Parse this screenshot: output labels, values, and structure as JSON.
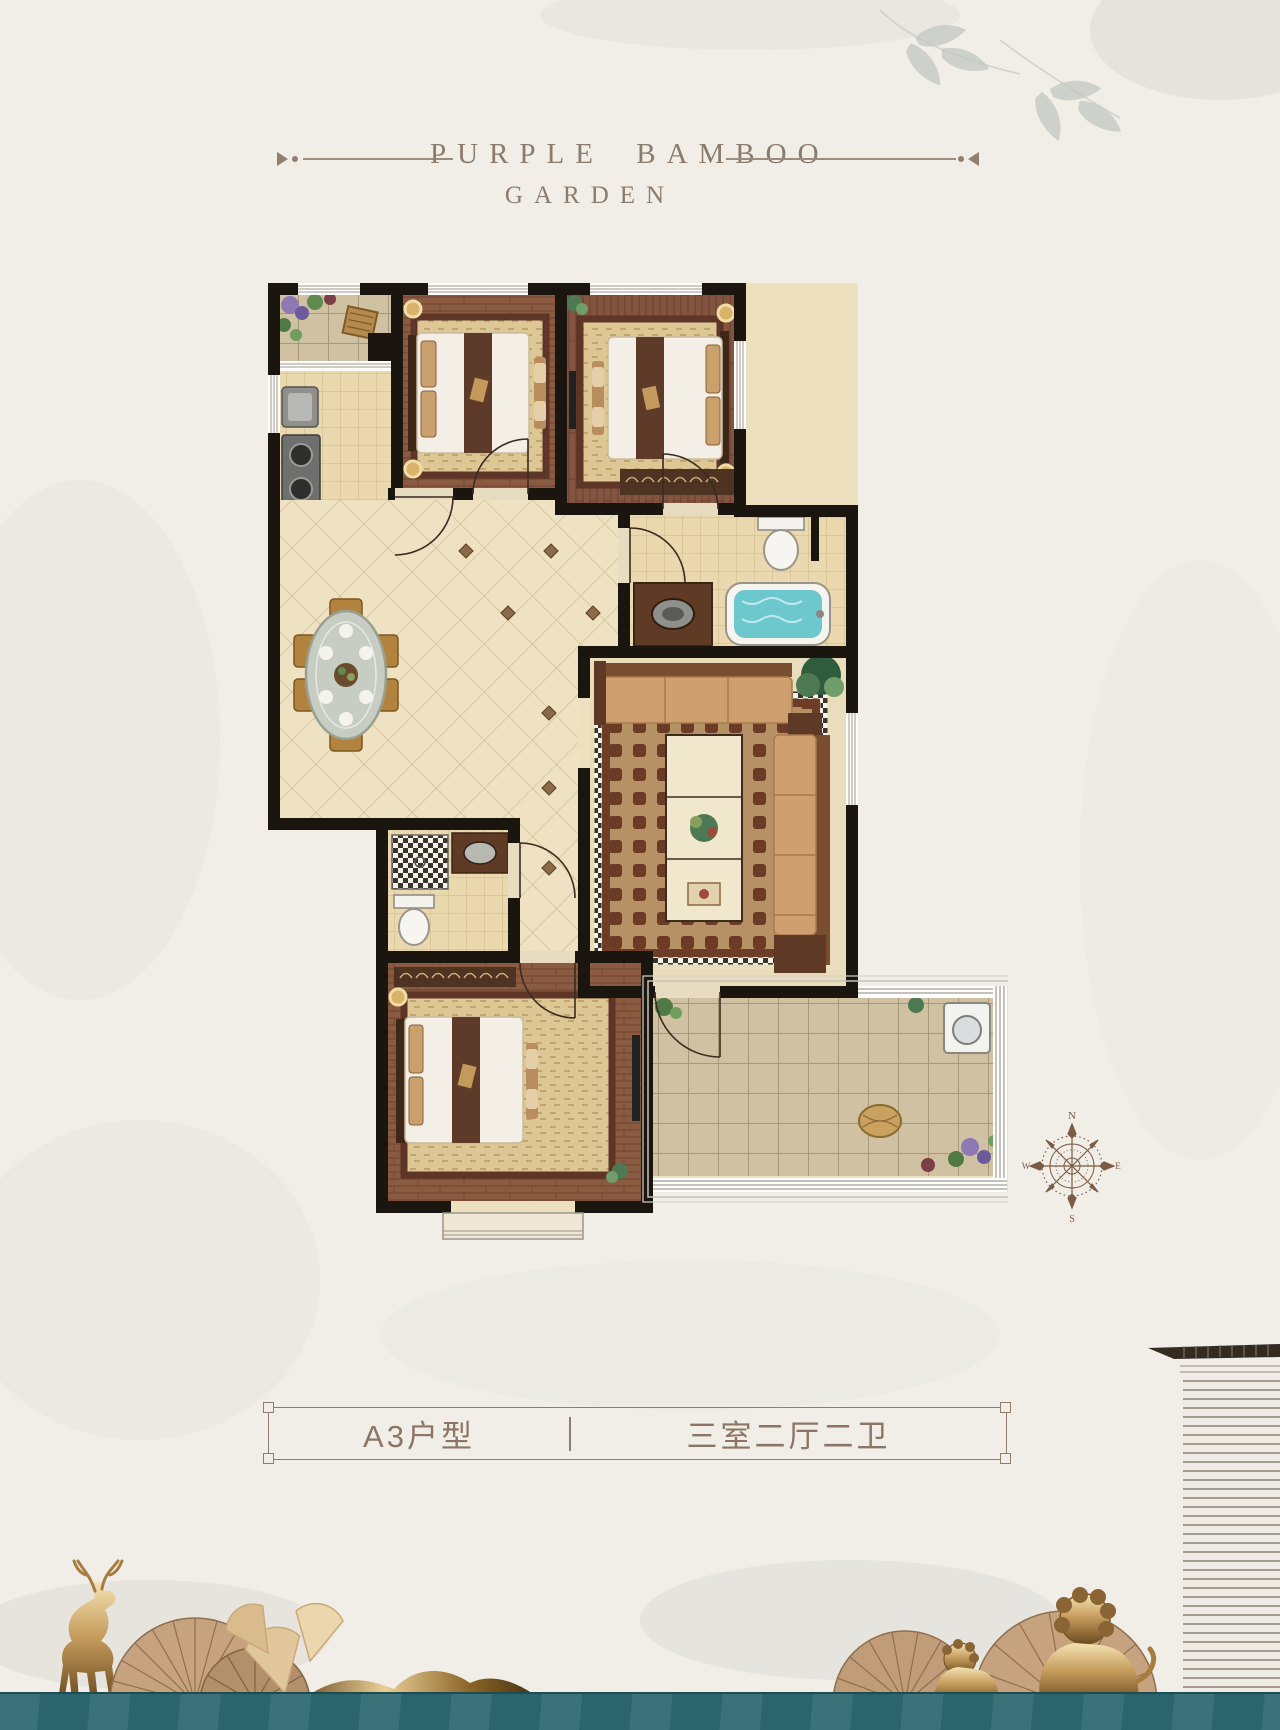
{
  "page": {
    "background": "#f0eee7",
    "water_color": "#2a656d"
  },
  "header": {
    "title_line1": "PURPLE BAMBOO",
    "title_line2": "GARDEN"
  },
  "plan_card": {
    "unit_name": "A3户型",
    "unit_layout": "三室二厅二卫"
  },
  "compass": {
    "north": "N",
    "south": "S",
    "east": "E",
    "west": "W"
  },
  "floorplan": {
    "areas": [
      "entry-garden",
      "kitchen",
      "bedroom-1",
      "bedroom-2",
      "hallway-dining",
      "master-bathroom",
      "living-room",
      "second-bathroom",
      "bedroom-3",
      "balcony"
    ]
  },
  "decor": [
    "bamboo-leaves",
    "deer-statue",
    "folding-fans",
    "ginkgo-leaves",
    "golden-mountains",
    "lion-statues",
    "roof-eave",
    "water-band"
  ],
  "colors": {
    "wall": "#1b1510",
    "wood": "#8a5a41",
    "tile": "#ecdfbe",
    "tub_water": "#6cc8cd",
    "title_brown": "#8b7b6d",
    "label_brown": "#8c7566",
    "gold": "#c39a5c"
  }
}
